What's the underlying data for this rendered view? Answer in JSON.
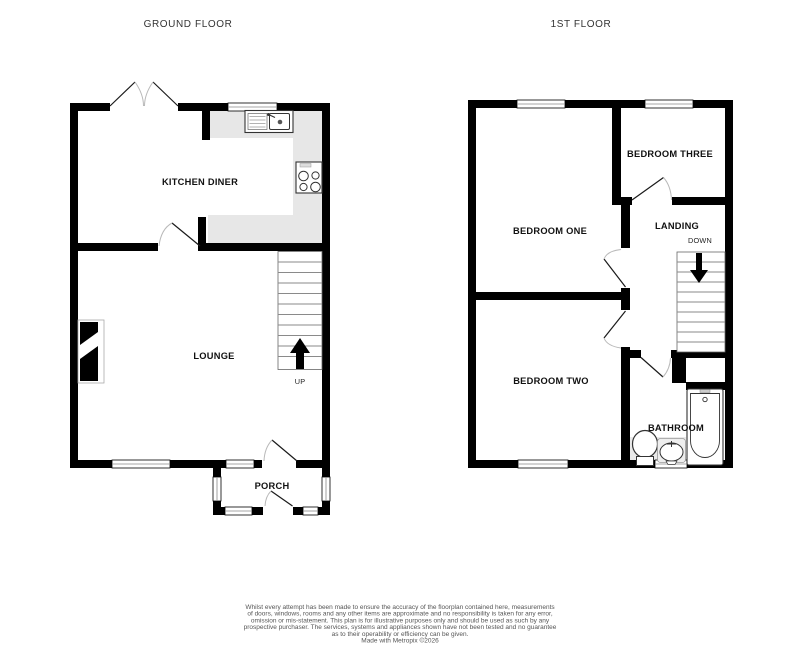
{
  "ground_floor": {
    "title": "GROUND FLOOR",
    "rooms": {
      "kitchen": "KITCHEN DINER",
      "lounge": "LOUNGE",
      "porch": "PORCH"
    },
    "stairs_direction": "UP"
  },
  "first_floor": {
    "title": "1ST FLOOR",
    "rooms": {
      "bedroom_one": "BEDROOM ONE",
      "bedroom_two": "BEDROOM TWO",
      "bedroom_three": "BEDROOM THREE",
      "landing": "LANDING",
      "bathroom": "BATHROOM"
    },
    "stairs_direction": "DOWN"
  },
  "disclaimer": {
    "lines": [
      "Whilst every attempt has been made to ensure the accuracy of the floorplan contained here, measurements",
      "of doors, windows, rooms and any other items are approximate and no responsibility is taken for any error,",
      "omission or mis-statement. This plan is for illustrative purposes only and should be used as such by any",
      "prospective purchaser. The services, systems and appliances shown have not been tested and no guarantee",
      "as to their operability or efficiency can be given."
    ],
    "credit": "Made with Metropix ©2026"
  },
  "colors": {
    "wall": "#000000",
    "kitchen_counter": "#e7e7e7",
    "bathroom_mat": "#e9e9e9",
    "stair_tread": "#8a8a8a",
    "door_arc": "#b9b9b9",
    "label_text": "#111111",
    "title_text": "#333333",
    "disclaimer_text": "#555555"
  }
}
